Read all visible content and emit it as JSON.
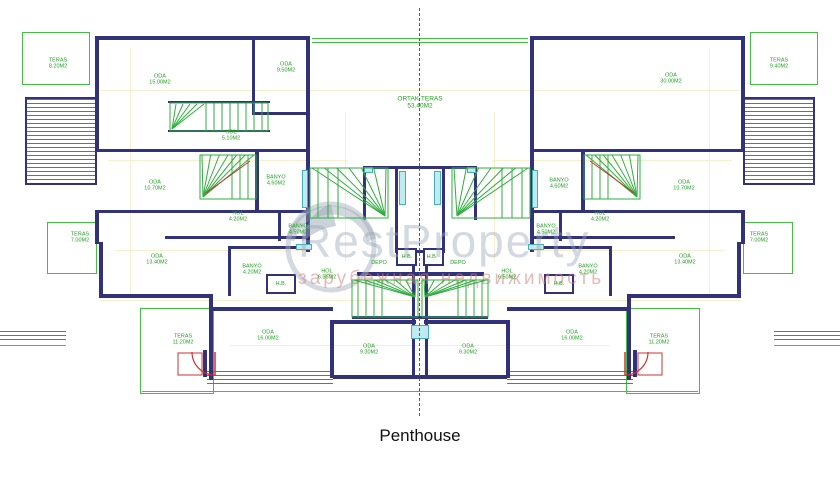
{
  "title": "Penthouse",
  "watermark": {
    "brand": "RestProperty",
    "tagline": "зарубежная недвижимость"
  },
  "colors": {
    "wall": "#32327a",
    "room_label": "#1fa31f",
    "stairs": "#2fae3e",
    "terrace": "#44bf44",
    "hatch": "#b0574a",
    "window": "#bfeaf0",
    "door": "#cc3333",
    "guide": "#f1eec2",
    "watermark_text": "#96a5b6",
    "watermark_tagline": "#d68080"
  },
  "rooms": [
    {
      "id": "teras_tl",
      "name": "TERAS",
      "area": "8.20M2"
    },
    {
      "id": "oda_tl",
      "name": "ODA",
      "area": "15.00M2"
    },
    {
      "id": "oda_tc",
      "name": "ODA",
      "area": "9.50M2"
    },
    {
      "id": "hol_tl",
      "name": "HOL",
      "area": "5.10M2"
    },
    {
      "id": "oda_ml",
      "name": "ODA",
      "area": "10.70M2"
    },
    {
      "id": "banyo_ml",
      "name": "BANYO",
      "area": "4.60M2"
    },
    {
      "id": "hol_ml",
      "name": "HOL",
      "area": "4.20M2"
    },
    {
      "id": "banyo_cl",
      "name": "BANYO",
      "area": "4.50M2"
    },
    {
      "id": "teras_ml",
      "name": "TERAS",
      "area": "7.00M2"
    },
    {
      "id": "oda_ll",
      "name": "ODA",
      "area": "13.40M2"
    },
    {
      "id": "banyo_ll",
      "name": "BANYO",
      "area": "4.20M2"
    },
    {
      "id": "hb_l",
      "name": "H.B.",
      "area": ""
    },
    {
      "id": "hol_bl",
      "name": "HOL",
      "area": "6.56M2"
    },
    {
      "id": "depo_l",
      "name": "DEPO",
      "area": ""
    },
    {
      "id": "hb_c1",
      "name": "H.B.",
      "area": ""
    },
    {
      "id": "hb_c2",
      "name": "H.B.",
      "area": ""
    },
    {
      "id": "teras_bl",
      "name": "TERAS",
      "area": "11.20M2"
    },
    {
      "id": "oda_bl",
      "name": "ODA",
      "area": "16.00M2"
    },
    {
      "id": "oda_bcl",
      "name": "ODA",
      "area": "9.30M2"
    },
    {
      "id": "ortak",
      "name": "ORTAK TERAS",
      "area": "53.40M2"
    },
    {
      "id": "oda_tr",
      "name": "ODA",
      "area": "30.00M2"
    },
    {
      "id": "teras_tr",
      "name": "TERAS",
      "area": "9.40M2"
    },
    {
      "id": "banyo_mr",
      "name": "BANYO",
      "area": "4.60M2"
    },
    {
      "id": "oda_mr",
      "name": "ODA",
      "area": "10.70M2"
    },
    {
      "id": "hol_mr",
      "name": "HOL",
      "area": "4.20M2"
    },
    {
      "id": "banyo_cr",
      "name": "BANYO",
      "area": "4.50M2"
    },
    {
      "id": "teras_mr",
      "name": "TERAS",
      "area": "7.00M2"
    },
    {
      "id": "oda_lr",
      "name": "ODA",
      "area": "13.40M2"
    },
    {
      "id": "banyo_lr",
      "name": "BANYO",
      "area": "4.20M2"
    },
    {
      "id": "hb_r",
      "name": "H.B.",
      "area": ""
    },
    {
      "id": "hol_br",
      "name": "HOL",
      "area": "6.50M2"
    },
    {
      "id": "depo_r",
      "name": "DEPO",
      "area": ""
    },
    {
      "id": "oda_bcr",
      "name": "ODA",
      "area": "9.30M2"
    },
    {
      "id": "oda_br",
      "name": "ODA",
      "area": "16.00M2"
    },
    {
      "id": "teras_br",
      "name": "TERAS",
      "area": "11.20M2"
    }
  ]
}
